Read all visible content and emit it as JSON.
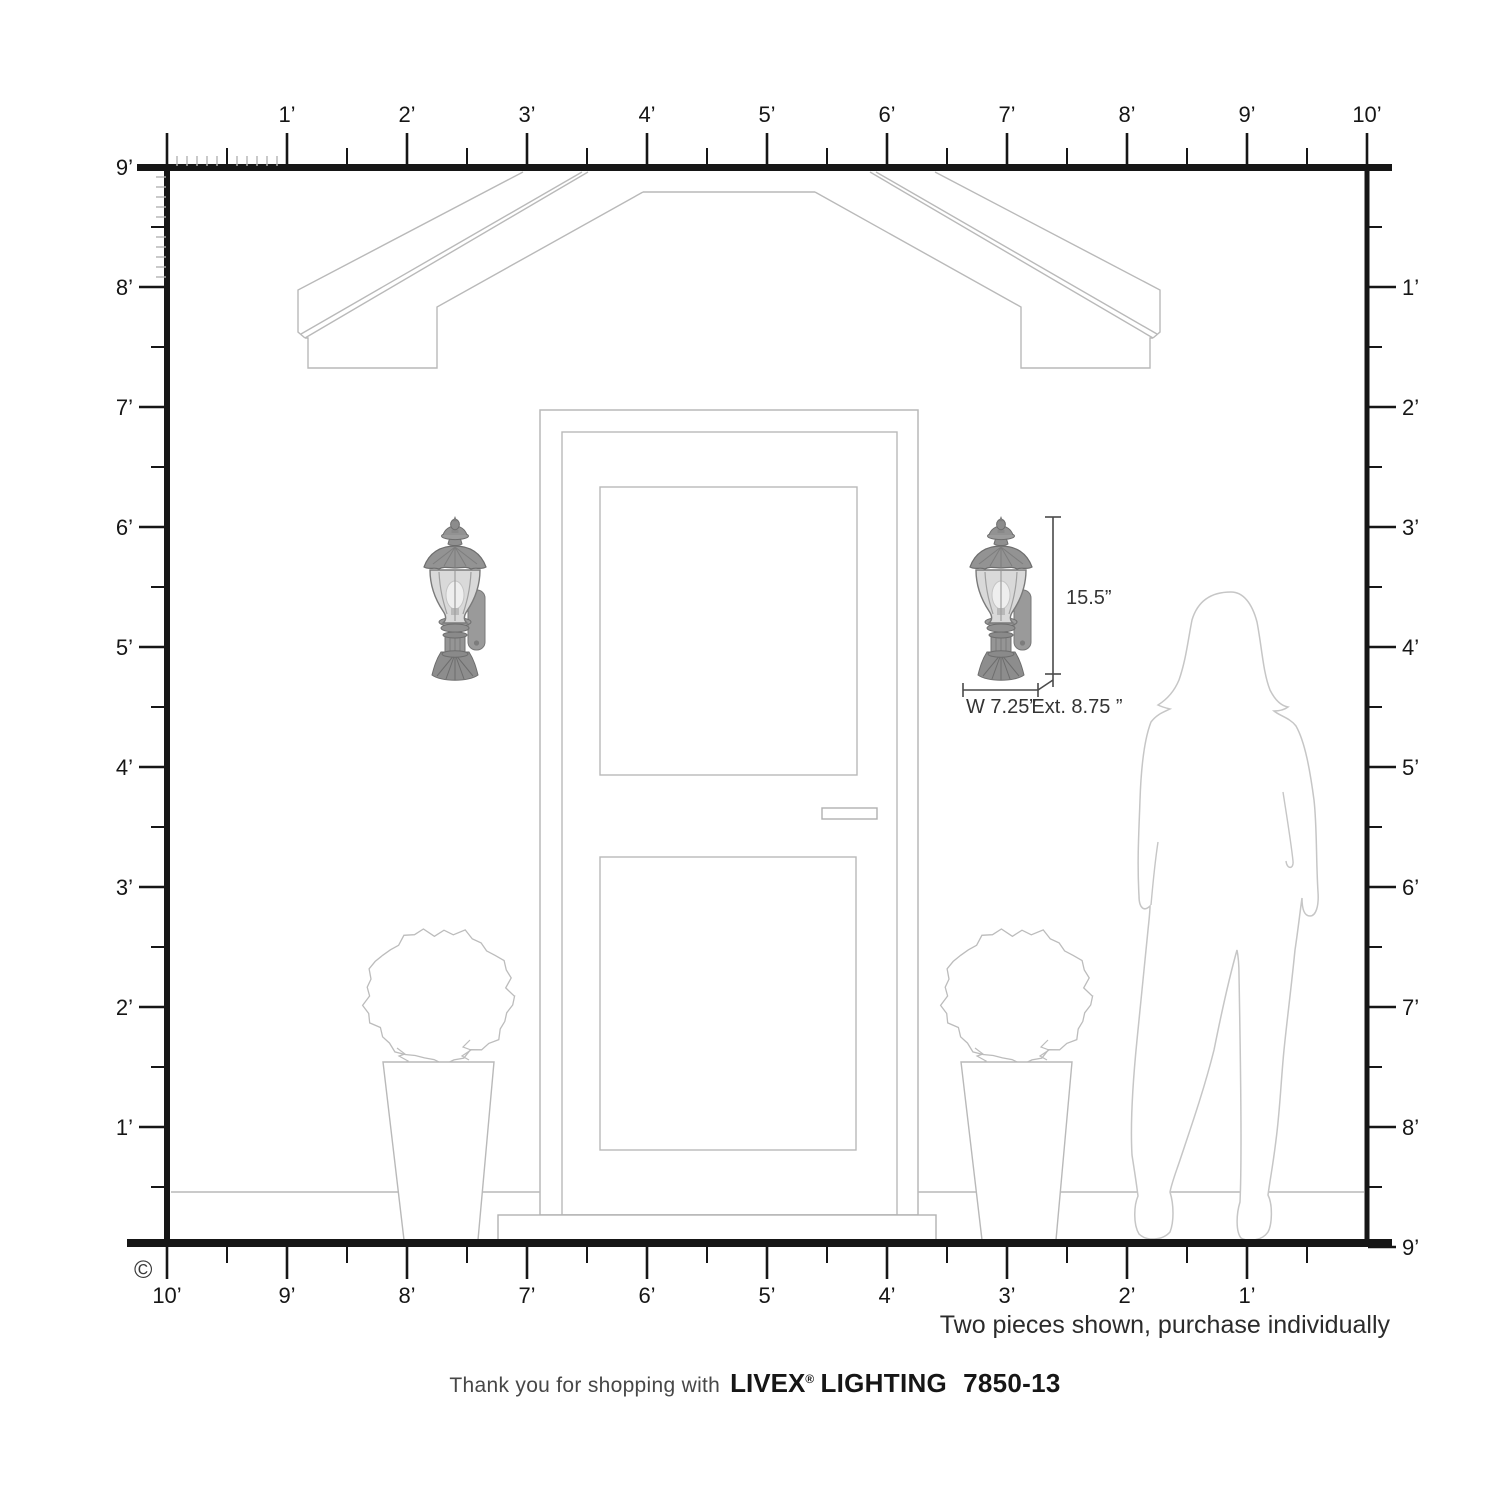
{
  "rulers": {
    "top_labels": [
      "1’",
      "2’",
      "3’",
      "4’",
      "5’",
      "6’",
      "7’",
      "8’",
      "9’",
      "10’"
    ],
    "left_labels": [
      "9’",
      "8’",
      "7’",
      "6’",
      "5’",
      "4’",
      "3’",
      "2’",
      "1’"
    ],
    "right_labels": [
      "1’",
      "2’",
      "3’",
      "4’",
      "5’",
      "6’",
      "7’",
      "8’",
      "9’"
    ],
    "bottom_labels": [
      "10’",
      "9’",
      "8’",
      "7’",
      "6’",
      "5’",
      "4’",
      "3’",
      "2’",
      "1’"
    ]
  },
  "dimensions": {
    "height": "15.5”",
    "width": "W 7.25”",
    "extension": "Ext. 8.75 ”"
  },
  "annotations": {
    "purchase_note": "Two pieces shown, purchase individually",
    "copyright_symbol": "©"
  },
  "footer": {
    "thanks": "Thank you for shopping with",
    "brand": "LIVEX",
    "registered_mark": "®",
    "brand_suffix": "LIGHTING",
    "model_number": "7850-13"
  },
  "icons": {
    "left_lantern": "wall-lantern-icon",
    "right_lantern": "wall-lantern-icon"
  },
  "colors": {
    "ruler": "#161616",
    "ruler_fine_tick": "#b3b3b3",
    "drawing_outline": "#b9b9b9",
    "silhouette_outline": "#c6c6c6",
    "dimension": "#3a3a3a",
    "text": "#2b2b2b",
    "lantern_body": "#8f8f8f",
    "lantern_glass": "#d9d9d9"
  }
}
